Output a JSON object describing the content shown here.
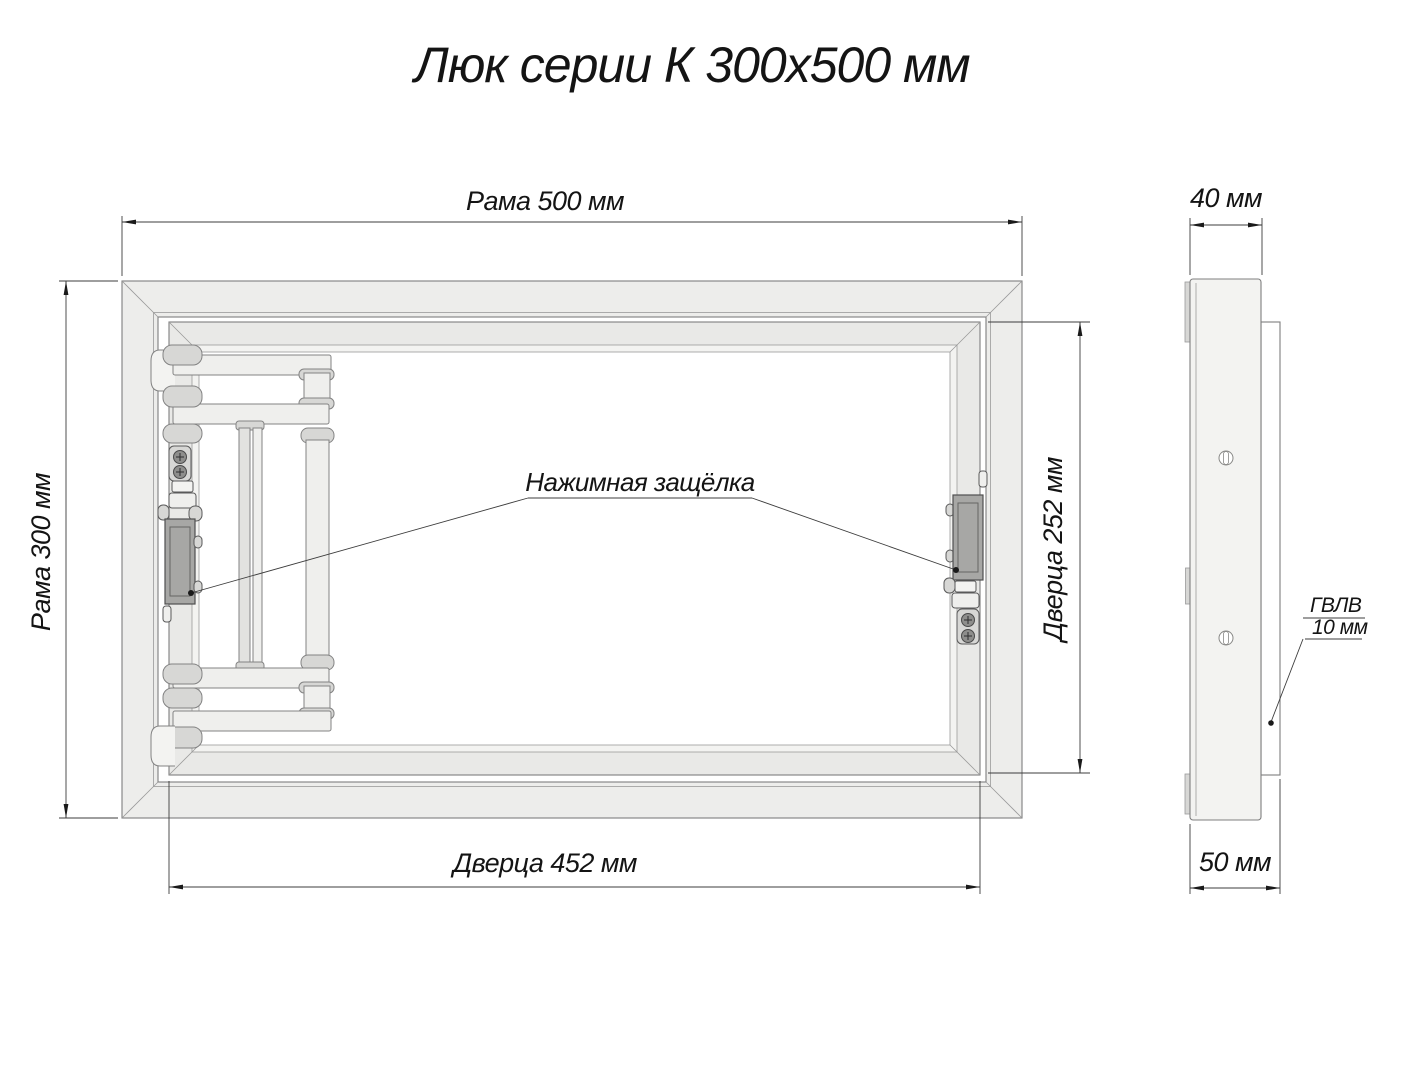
{
  "title": "Люк серии К 300х500 мм",
  "front_view": {
    "frame_width_label": "Рама 500 мм",
    "frame_height_label": "Рама 300 мм",
    "door_width_label": "Дверца 452 мм",
    "door_height_label": "Дверца 252 мм",
    "latch_callout": "Нажимная защёлка"
  },
  "side_view": {
    "frame_depth_label": "40 мм",
    "total_depth_label": "50 мм",
    "panel_material_label": "ГВЛВ",
    "panel_thickness_label": "10 мм"
  },
  "dimensions_mm": {
    "frame_width": 500,
    "frame_height": 300,
    "door_width": 452,
    "door_height": 252,
    "frame_depth": 40,
    "total_depth": 50,
    "panel_thickness": 10
  },
  "colors": {
    "background": "#ffffff",
    "frame_fill": "#ededeb",
    "door_fill": "#e9e9e7",
    "latch_fill": "#a7a7a5",
    "outline": "#7f7f7f",
    "dimension_line": "#3c3c3c",
    "text": "#141414"
  }
}
